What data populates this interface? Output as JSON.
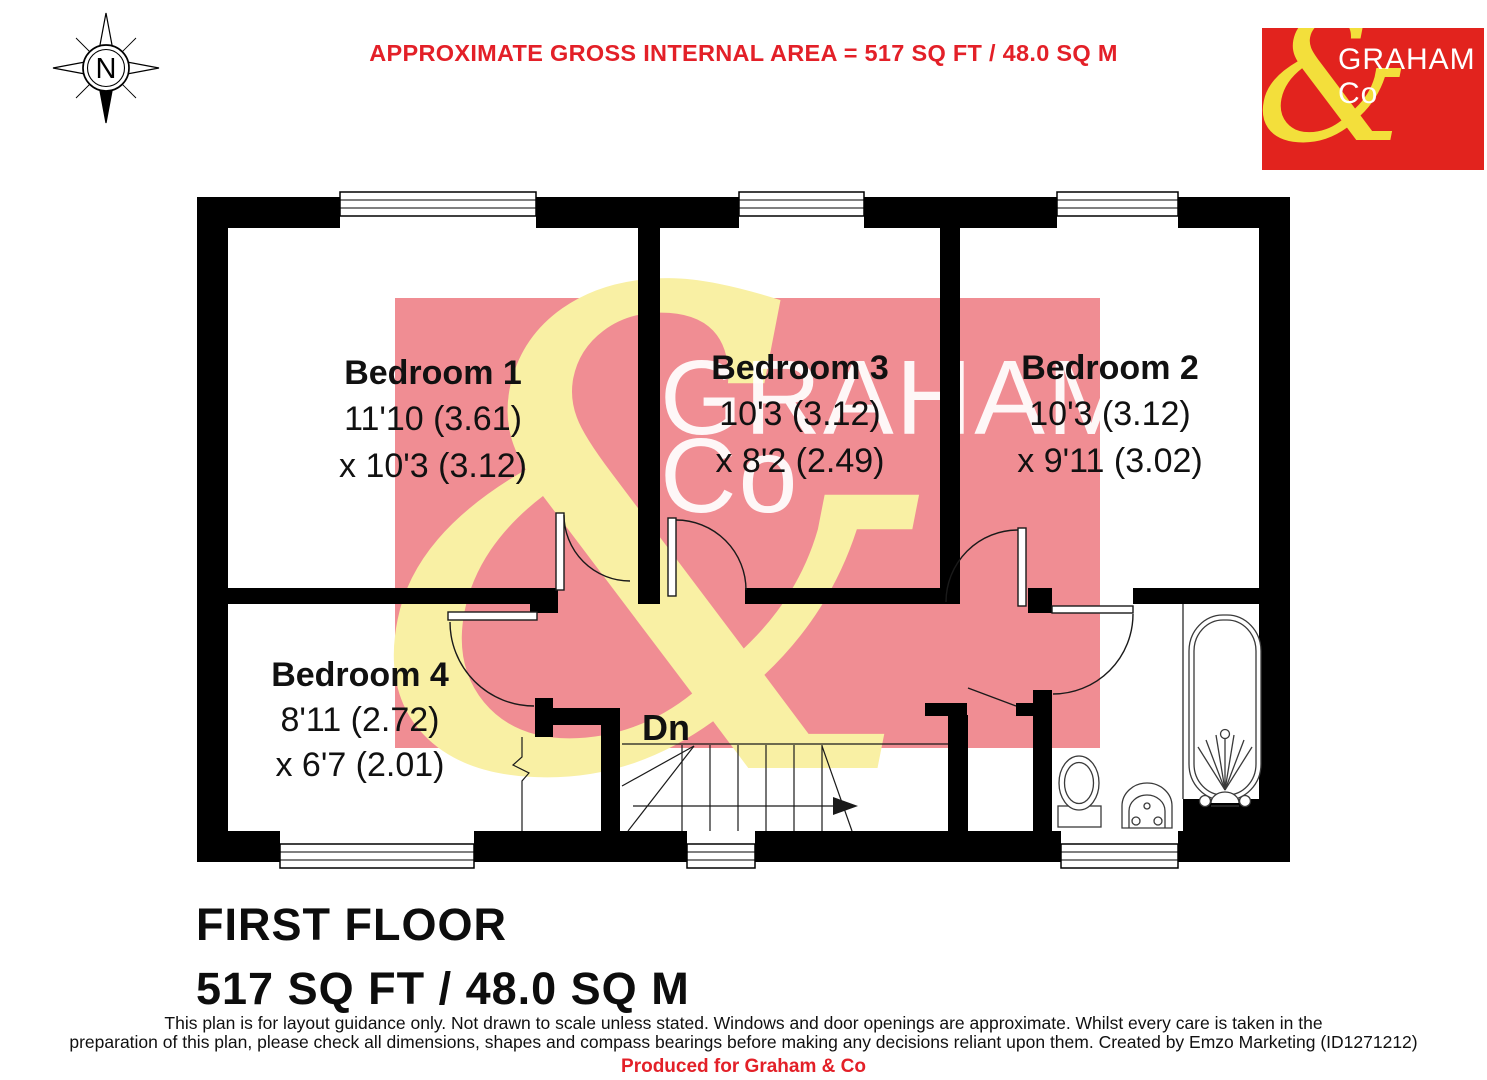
{
  "header": {
    "compass_label": "N",
    "area_title": "APPROXIMATE GROSS INTERNAL AREA = 517 SQ FT / 48.0 SQ M"
  },
  "logo": {
    "ampersand": "&",
    "line1": "GRAHAM",
    "line2": "Co"
  },
  "watermark": {
    "ampersand": "&",
    "line1": "GRAHAM",
    "line2": "Co"
  },
  "rooms": [
    {
      "name": "Bedroom 1",
      "dim1": "11'10 (3.61)",
      "dim2": "x 10'3 (3.12)"
    },
    {
      "name": "Bedroom 3",
      "dim1": "10'3 (3.12)",
      "dim2": "x 8'2 (2.49)"
    },
    {
      "name": "Bedroom 2",
      "dim1": "10'3 (3.12)",
      "dim2": "x 9'11 (3.02)"
    },
    {
      "name": "Bedroom 4",
      "dim1": "8'11 (2.72)",
      "dim2": "x 6'7 (2.01)"
    }
  ],
  "stairs_label": "Dn",
  "footer": {
    "floor_name": "FIRST FLOOR",
    "floor_area": "517 SQ FT / 48.0 SQ M",
    "disclaimer_line1": "This plan is for layout guidance only. Not drawn to scale unless stated. Windows and door openings are approximate. Whilst every care is taken in the",
    "disclaimer_line2": "preparation of this plan, please check all dimensions, shapes and compass bearings before making any decisions reliant upon them. Created by Emzo Marketing (ID1271212)",
    "produced_for": "Produced for Graham & Co"
  },
  "colors": {
    "brand_red": "#e2231e",
    "accent_red": "#e32028",
    "brand_yellow": "#f3df3b",
    "watermark_pink": "#f08d93",
    "watermark_yellow": "#f9f0a4"
  }
}
